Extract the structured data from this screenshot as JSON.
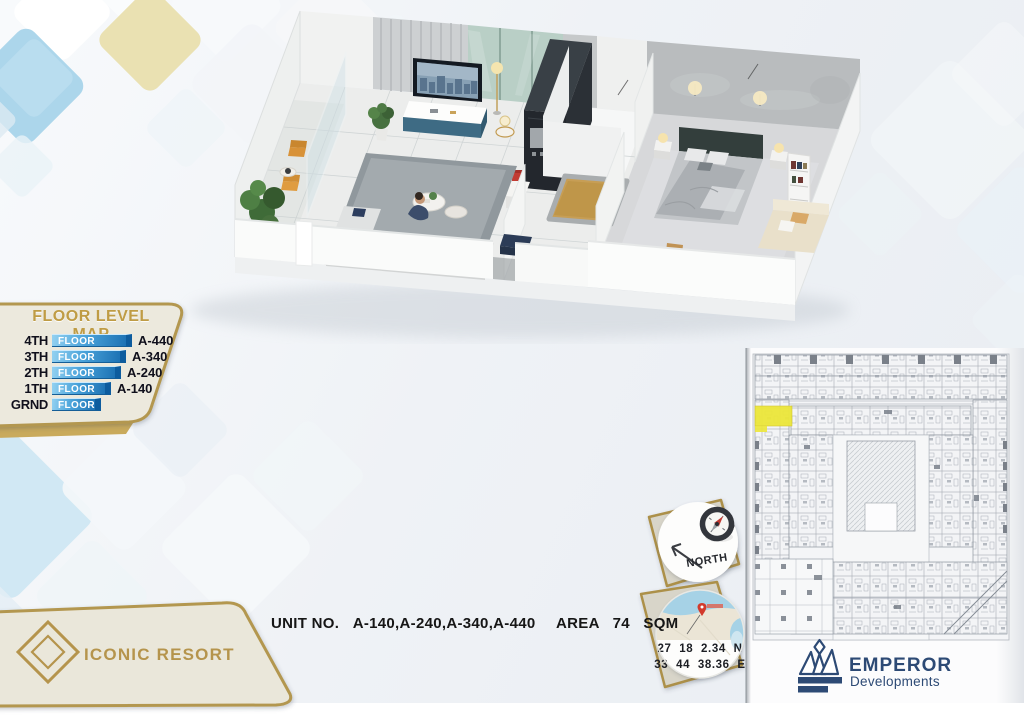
{
  "branding": {
    "resort_name": "ICONIC RESORT",
    "developer_name": "EMPEROR",
    "developer_tagline": "Developments"
  },
  "floor_level_map": {
    "title": "FLOOR LEVEL MAP",
    "rows": [
      {
        "level": "4TH",
        "bar_label": "FLOOR",
        "code": "A-440"
      },
      {
        "level": "3TH",
        "bar_label": "FLOOR",
        "code": "A-340"
      },
      {
        "level": "2TH",
        "bar_label": "FLOOR",
        "code": "A-240"
      },
      {
        "level": "1TH",
        "bar_label": "FLOOR",
        "code": "A-140"
      },
      {
        "level": "GRND",
        "bar_label": "FLOOR",
        "code": ""
      }
    ]
  },
  "unit_info": {
    "unit_label": "UNIT NO.",
    "unit_numbers": "A-140,A-240,A-340,A-440",
    "area_label": "AREA",
    "area_value": "74",
    "area_unit": "SQM"
  },
  "compass": {
    "label": "NORTH"
  },
  "location": {
    "latitude": "27 18 2.34 N",
    "longitude": "33 44 38.36 E"
  },
  "site_plan": {
    "highlighted_unit": "A unit highlighted yellow on west wing",
    "highlight_color": "#ece73a"
  },
  "colors": {
    "gold": "#b3974f",
    "bar_blue": "#2f84c2",
    "navy": "#2d4a75",
    "cream_panel": "#ece9dd"
  }
}
